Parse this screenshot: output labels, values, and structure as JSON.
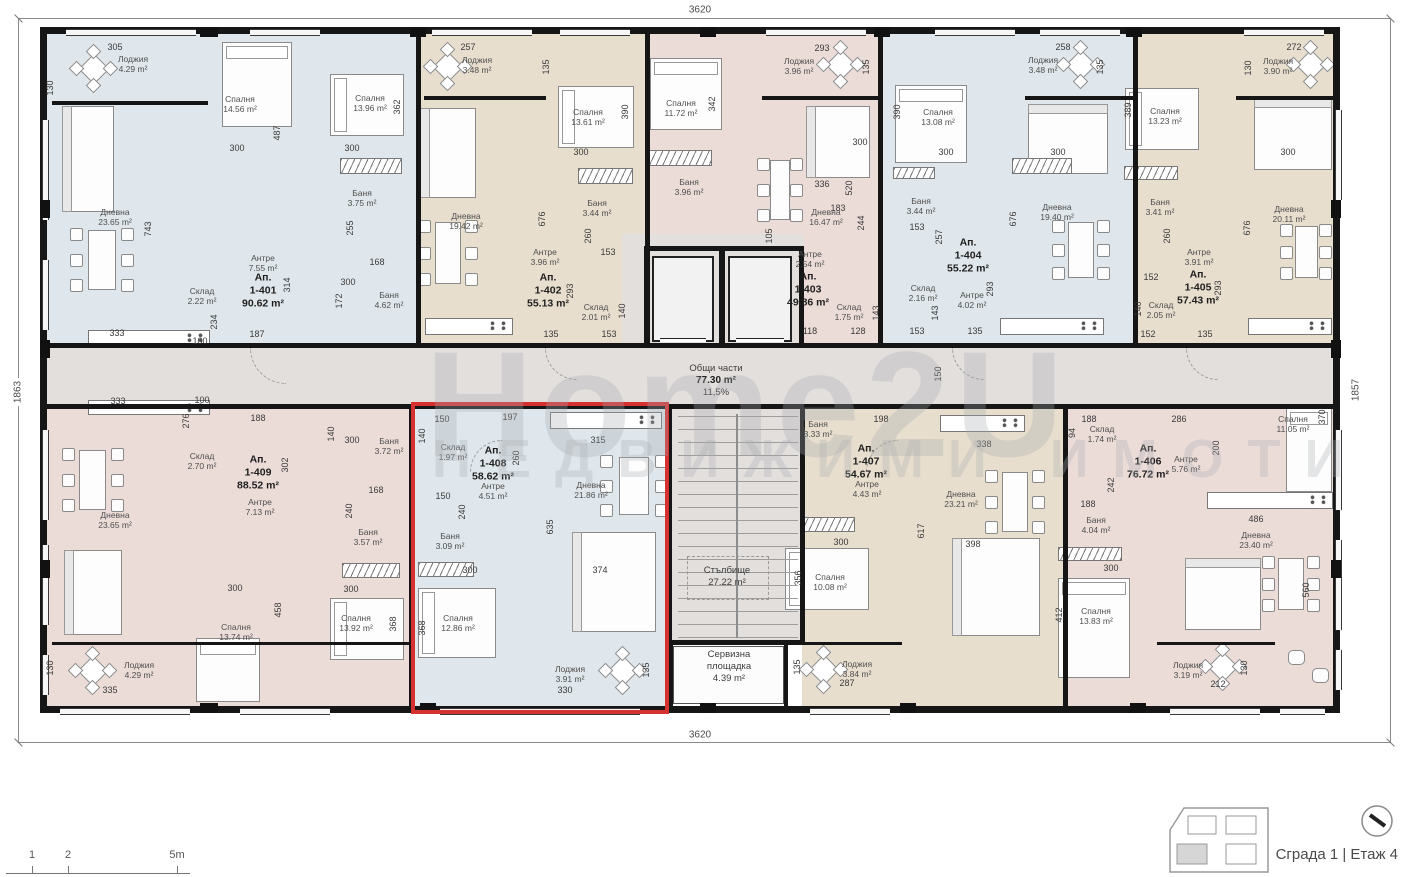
{
  "watermark": {
    "line1": "Home2U",
    "line2": "НЕДВИЖИМИ ИМОТИ"
  },
  "outer_dimensions": {
    "top": "3620",
    "bottom": "3620",
    "left": "1863",
    "right": "1857"
  },
  "footer": {
    "building_floor_label": "Сграда 1 | Етаж 4"
  },
  "scale_bar": {
    "ticks": [
      {
        "label": "1",
        "x": 32
      },
      {
        "label": "2",
        "x": 68
      },
      {
        "label": "5m",
        "x": 177
      }
    ]
  },
  "colors": {
    "blue": "#dfe7ec",
    "beige": "#e7decd",
    "pink": "#ebdcd8",
    "common": "#e2dfdd",
    "wall": "#161616",
    "highlight": "#d63131"
  },
  "common": {
    "shared": {
      "name": "Общи части",
      "area": "77.30 m²",
      "share": "11,5%"
    },
    "stairs": {
      "name": "Стълбище",
      "area": "27.22 m²"
    },
    "service": {
      "name": "Сервизна площадка",
      "area": "4.39 m²"
    }
  },
  "apartments": [
    {
      "prefix": "Ап.",
      "num": "1-401",
      "area": "90.62 m²",
      "color": "blue",
      "label": [
        263,
        291
      ],
      "rooms": [
        [
          "Лоджия",
          "4.29 m²",
          133,
          64
        ],
        [
          "Спалня",
          "14.56 m²",
          240,
          104
        ],
        [
          "Спалня",
          "13.96 m²",
          370,
          103
        ],
        [
          "Дневна",
          "23.65 m²",
          115,
          217
        ],
        [
          "Баня",
          "3.75 m²",
          362,
          198
        ],
        [
          "Антре",
          "7.55 m²",
          263,
          263
        ],
        [
          "Склад",
          "2.22 m²",
          202,
          296
        ],
        [
          "Баня",
          "4.62 m²",
          389,
          300
        ]
      ]
    },
    {
      "prefix": "Ап.",
      "num": "1-402",
      "area": "55.13 m²",
      "color": "beige",
      "label": [
        548,
        291
      ],
      "rooms": [
        [
          "Лоджия",
          "3.48 m²",
          477,
          65
        ],
        [
          "Спалня",
          "13.61 m²",
          588,
          117
        ],
        [
          "Дневна",
          "19.42 m²",
          466,
          221
        ],
        [
          "Баня",
          "3.44 m²",
          597,
          208
        ],
        [
          "Антре",
          "3.96 m²",
          545,
          257
        ],
        [
          "Склад",
          "2.01 m²",
          596,
          312
        ]
      ]
    },
    {
      "prefix": "Ап.",
      "num": "1-403",
      "area": "49.86 m²",
      "color": "pink",
      "label": [
        808,
        290
      ],
      "rooms": [
        [
          "Лоджия",
          "3.96 m²",
          799,
          66
        ],
        [
          "Спалня",
          "11.72 m²",
          681,
          108
        ],
        [
          "Баня",
          "3.96 m²",
          689,
          187
        ],
        [
          "Дневна",
          "16.47 m²",
          826,
          217
        ],
        [
          "Антре",
          "2.54 m²",
          810,
          259
        ],
        [
          "Склад",
          "1.75 m²",
          849,
          312
        ]
      ]
    },
    {
      "prefix": "Ап.",
      "num": "1-404",
      "area": "55.22 m²",
      "color": "blue",
      "label": [
        968,
        256
      ],
      "rooms": [
        [
          "Лоджия",
          "3.48 m²",
          1043,
          65
        ],
        [
          "Спалня",
          "13.08 m²",
          938,
          117
        ],
        [
          "Баня",
          "3.44 m²",
          921,
          206
        ],
        [
          "Дневна",
          "19.40 m²",
          1057,
          212
        ],
        [
          "Склад",
          "2.16 m²",
          923,
          293
        ],
        [
          "Антре",
          "4.02 m²",
          972,
          300
        ]
      ]
    },
    {
      "prefix": "Ап.",
      "num": "1-405",
      "area": "57.43 m²",
      "color": "beige",
      "label": [
        1198,
        288
      ],
      "rooms": [
        [
          "Лоджия",
          "3.90 m²",
          1278,
          66
        ],
        [
          "Спалня",
          "13.23 m²",
          1165,
          116
        ],
        [
          "Баня",
          "3.41 m²",
          1160,
          207
        ],
        [
          "Дневна",
          "20.11 m²",
          1289,
          214
        ],
        [
          "Антре",
          "3.91 m²",
          1199,
          257
        ],
        [
          "Склад",
          "2.05 m²",
          1161,
          310
        ]
      ]
    },
    {
      "prefix": "Ап.",
      "num": "1-406",
      "area": "76.72 m²",
      "color": "pink",
      "label": [
        1148,
        462
      ],
      "rooms": [
        [
          "Склад",
          "1.74 m²",
          1102,
          434
        ],
        [
          "Спалня",
          "11.05 m²",
          1293,
          424
        ],
        [
          "Антре",
          "5.76 m²",
          1186,
          464
        ],
        [
          "Баня",
          "4.04 m²",
          1096,
          525
        ],
        [
          "Дневна",
          "23.40 m²",
          1256,
          540
        ],
        [
          "Спалня",
          "13.83 m²",
          1096,
          616
        ],
        [
          "Лоджия",
          "3.19 m²",
          1188,
          670
        ]
      ]
    },
    {
      "prefix": "Ап.",
      "num": "1-407",
      "area": "54.67 m²",
      "color": "beige",
      "label": [
        866,
        462
      ],
      "rooms": [
        [
          "Баня",
          "3.33 m²",
          818,
          429
        ],
        [
          "Антре",
          "4.43 m²",
          867,
          489
        ],
        [
          "Дневна",
          "23.21 m²",
          961,
          499
        ],
        [
          "Спалня",
          "10.08 m²",
          830,
          582
        ],
        [
          "Лоджия",
          "3.84 m²",
          857,
          669
        ]
      ]
    },
    {
      "prefix": "Ап.",
      "num": "1-408",
      "area": "58.62 m²",
      "color": "blue",
      "selected": true,
      "label": [
        493,
        464
      ],
      "rooms": [
        [
          "Склад",
          "1.97 m²",
          453,
          452
        ],
        [
          "Антре",
          "4.51 m²",
          493,
          491
        ],
        [
          "Дневна",
          "21.86 m²",
          591,
          490
        ],
        [
          "Баня",
          "3.09 m²",
          450,
          541
        ],
        [
          "Спалня",
          "12.86 m²",
          458,
          623
        ],
        [
          "Лоджия",
          "3.91 m²",
          570,
          674
        ]
      ]
    },
    {
      "prefix": "Ап.",
      "num": "1-409",
      "area": "88.52 m²",
      "color": "pink",
      "label": [
        258,
        473
      ],
      "rooms": [
        [
          "Склад",
          "2.70 m²",
          202,
          461
        ],
        [
          "Баня",
          "3.72 m²",
          389,
          446
        ],
        [
          "Антре",
          "7.13 m²",
          260,
          507
        ],
        [
          "Дневна",
          "23.65 m²",
          115,
          520
        ],
        [
          "Баня",
          "3.57 m²",
          368,
          537
        ],
        [
          "Спалня",
          "13.74 m²",
          236,
          632
        ],
        [
          "Спалня",
          "13.92 m²",
          356,
          623
        ],
        [
          "Лоджия",
          "4.29 m²",
          139,
          670
        ]
      ]
    }
  ],
  "dims": [
    [
      "305",
      115,
      47,
      0
    ],
    [
      "130",
      50,
      88,
      1
    ],
    [
      "487",
      277,
      133,
      1
    ],
    [
      "362",
      397,
      107,
      1
    ],
    [
      "300",
      237,
      148,
      0
    ],
    [
      "300",
      352,
      148,
      0
    ],
    [
      "743",
      148,
      229,
      1
    ],
    [
      "255",
      350,
      228,
      1
    ],
    [
      "168",
      377,
      262,
      0
    ],
    [
      "314",
      287,
      285,
      1
    ],
    [
      "172",
      339,
      301,
      1
    ],
    [
      "234",
      214,
      322,
      1
    ],
    [
      "187",
      257,
      334,
      0
    ],
    [
      "333",
      117,
      333,
      0
    ],
    [
      "100",
      200,
      341,
      0
    ],
    [
      "300",
      348,
      282,
      0
    ],
    [
      "257",
      468,
      47,
      0
    ],
    [
      "135",
      546,
      67,
      1
    ],
    [
      "390",
      625,
      112,
      1
    ],
    [
      "300",
      581,
      152,
      0
    ],
    [
      "676",
      542,
      219,
      1
    ],
    [
      "260",
      588,
      236,
      1
    ],
    [
      "153",
      608,
      252,
      0
    ],
    [
      "293",
      570,
      291,
      1
    ],
    [
      "140",
      622,
      311,
      1
    ],
    [
      "135",
      551,
      334,
      0
    ],
    [
      "153",
      609,
      334,
      0
    ],
    [
      "342",
      712,
      104,
      1
    ],
    [
      "293",
      822,
      48,
      0
    ],
    [
      "135",
      866,
      67,
      1
    ],
    [
      "300",
      860,
      142,
      0
    ],
    [
      "183",
      838,
      208,
      0
    ],
    [
      "244",
      861,
      223,
      1
    ],
    [
      "105",
      769,
      236,
      1
    ],
    [
      "336",
      822,
      184,
      0
    ],
    [
      "520",
      849,
      188,
      1
    ],
    [
      "118",
      810,
      331,
      0
    ],
    [
      "128",
      858,
      331,
      0
    ],
    [
      "143",
      876,
      313,
      1
    ],
    [
      "390",
      897,
      112,
      1
    ],
    [
      "300",
      946,
      152,
      0
    ],
    [
      "153",
      917,
      227,
      0
    ],
    [
      "257",
      939,
      237,
      1
    ],
    [
      "143",
      935,
      313,
      1
    ],
    [
      "153",
      917,
      331,
      0
    ],
    [
      "135",
      975,
      331,
      0
    ],
    [
      "293",
      990,
      289,
      1
    ],
    [
      "676",
      1013,
      219,
      1
    ],
    [
      "300",
      1058,
      152,
      0
    ],
    [
      "258",
      1063,
      47,
      0
    ],
    [
      "135",
      1100,
      67,
      1
    ],
    [
      "389",
      1128,
      110,
      1
    ],
    [
      "272",
      1294,
      47,
      0
    ],
    [
      "130",
      1248,
      68,
      1
    ],
    [
      "300",
      1288,
      152,
      0
    ],
    [
      "260",
      1167,
      236,
      1
    ],
    [
      "152",
      1151,
      277,
      0
    ],
    [
      "140",
      1138,
      309,
      1
    ],
    [
      "152",
      1148,
      334,
      0
    ],
    [
      "135",
      1205,
      334,
      0
    ],
    [
      "293",
      1218,
      288,
      1
    ],
    [
      "676",
      1247,
      228,
      1
    ],
    [
      "150",
      938,
      374,
      1
    ],
    [
      "198",
      881,
      419,
      0
    ],
    [
      "315",
      598,
      440,
      0
    ],
    [
      "338",
      984,
      444,
      0
    ],
    [
      "333",
      118,
      401,
      0
    ],
    [
      "100",
      202,
      400,
      0
    ],
    [
      "276",
      186,
      421,
      1
    ],
    [
      "188",
      258,
      418,
      0
    ],
    [
      "140",
      331,
      434,
      1
    ],
    [
      "300",
      352,
      440,
      0
    ],
    [
      "302",
      285,
      465,
      1
    ],
    [
      "168",
      376,
      490,
      0
    ],
    [
      "240",
      349,
      511,
      1
    ],
    [
      "300",
      351,
      589,
      0
    ],
    [
      "458",
      278,
      610,
      1
    ],
    [
      "300",
      235,
      588,
      0
    ],
    [
      "368",
      393,
      624,
      1
    ],
    [
      "130",
      50,
      668,
      1
    ],
    [
      "335",
      110,
      690,
      0
    ],
    [
      "150",
      442,
      419,
      0
    ],
    [
      "197",
      510,
      417,
      0
    ],
    [
      "140",
      422,
      436,
      1
    ],
    [
      "260",
      516,
      458,
      1
    ],
    [
      "150",
      443,
      496,
      0
    ],
    [
      "240",
      462,
      512,
      1
    ],
    [
      "635",
      550,
      527,
      1
    ],
    [
      "300",
      470,
      570,
      0
    ],
    [
      "374",
      600,
      570,
      0
    ],
    [
      "368",
      422,
      628,
      1
    ],
    [
      "135",
      646,
      670,
      1
    ],
    [
      "330",
      565,
      690,
      0
    ],
    [
      "356",
      798,
      578,
      1
    ],
    [
      "300",
      841,
      542,
      0
    ],
    [
      "617",
      921,
      531,
      1
    ],
    [
      "287",
      847,
      683,
      0
    ],
    [
      "135",
      797,
      667,
      1
    ],
    [
      "398",
      973,
      544,
      0
    ],
    [
      "188",
      1089,
      419,
      0
    ],
    [
      "94",
      1072,
      433,
      1
    ],
    [
      "242",
      1111,
      485,
      1
    ],
    [
      "188",
      1088,
      504,
      0
    ],
    [
      "300",
      1111,
      568,
      0
    ],
    [
      "412",
      1059,
      615,
      1
    ],
    [
      "286",
      1179,
      419,
      0
    ],
    [
      "370",
      1322,
      417,
      1
    ],
    [
      "200",
      1216,
      448,
      1
    ],
    [
      "486",
      1256,
      519,
      0
    ],
    [
      "560",
      1306,
      590,
      1
    ],
    [
      "130",
      1244,
      668,
      1
    ],
    [
      "212",
      1218,
      684,
      0
    ]
  ]
}
